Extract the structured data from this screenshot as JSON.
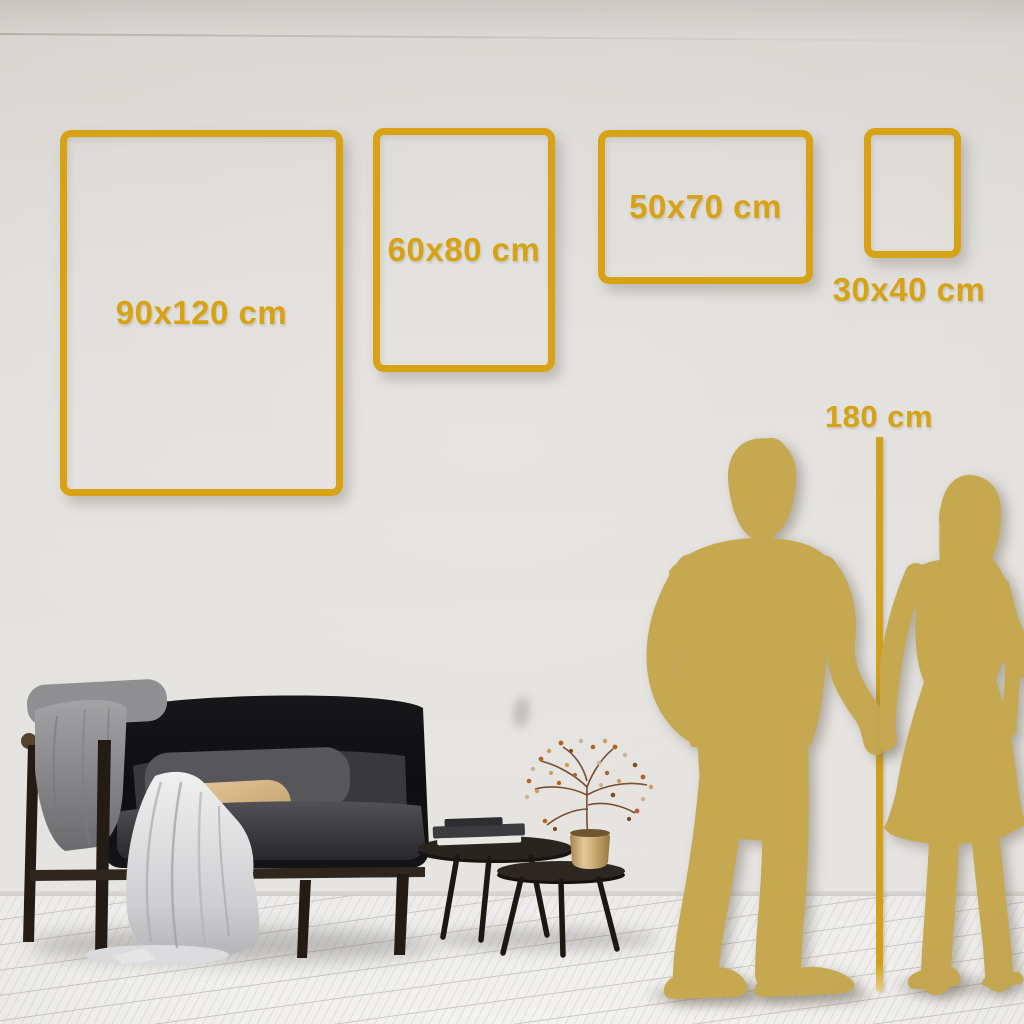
{
  "size_guide": {
    "frames": [
      {
        "label": "90x120 cm"
      },
      {
        "label": "60x80 cm"
      },
      {
        "label": "50x70 cm"
      },
      {
        "label": "30x40 cm"
      }
    ],
    "height_reference": {
      "label": "180 cm"
    }
  },
  "colors": {
    "accent_gold": "#D7A314",
    "silhouette_gold": "#C6A851",
    "wall": "#E0DDD9",
    "floor": "#F1F0EE"
  }
}
